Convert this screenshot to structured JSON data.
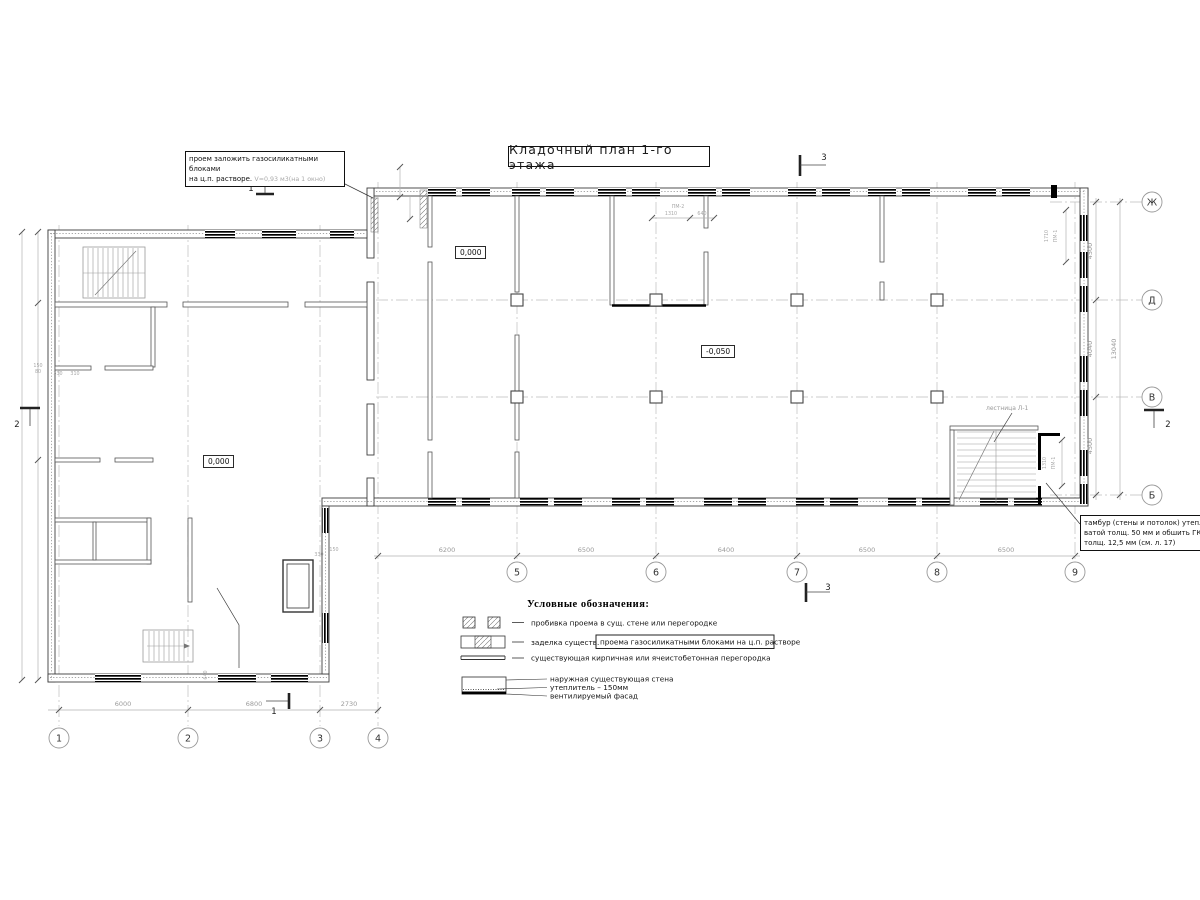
{
  "title": "Кладочный план 1-го этажа",
  "callout_opening": {
    "line1": "проем заложить газосиликатными блоками",
    "line2": "на ц.п. растворе.",
    "note": "V=0,93 м3(на 1 окно)"
  },
  "callout_tambour": {
    "line1": "тамбур (стены и потолок) утеплить",
    "line2": "ватой толщ. 50 мм и обшить ГКЛ",
    "line3": "толщ. 12,5 мм (см. л. 17)"
  },
  "elevations": {
    "hall_zero": "0,000",
    "wing_zero": "0,000",
    "hall_low": "-0,050"
  },
  "grid": {
    "cols": [
      {
        "label": "1"
      },
      {
        "label": "2"
      },
      {
        "label": "3"
      },
      {
        "label": "4"
      },
      {
        "label": "5"
      },
      {
        "label": "6"
      },
      {
        "label": "7"
      },
      {
        "label": "8"
      },
      {
        "label": "9"
      }
    ],
    "rows": [
      {
        "label": "Ж"
      },
      {
        "label": "Д"
      },
      {
        "label": "В"
      },
      {
        "label": "Б"
      }
    ]
  },
  "dims": {
    "bottom_main": [
      "6200",
      "6500",
      "6400",
      "6500",
      "6500"
    ],
    "bottom_wing": [
      "6000",
      "6800",
      "2730"
    ],
    "right_segments": [
      "4500",
      "4040",
      "4500"
    ],
    "right_total": "13040",
    "pm2": {
      "label": "ПМ-2",
      "d1": "1310",
      "d2": "640"
    },
    "pm1_top": {
      "label": "ПМ-1",
      "d": "1710"
    },
    "pm1_stair": {
      "label": "ПМ-1",
      "d": "1310"
    },
    "small_left": [
      "150",
      "80",
      "330",
      "310"
    ],
    "small_tambour": [
      "330",
      "150"
    ],
    "wing_640": "640"
  },
  "labels": {
    "stair": "лестница Л-1"
  },
  "sections": {
    "s1": "1",
    "s2": "2",
    "s3": "3"
  },
  "legend": {
    "heading": "Условные обозначения:",
    "items": [
      {
        "text": "пробивка проема в сущ. стене или перегородке"
      },
      {
        "prefix": "заделка существ.",
        "boxed": "проема газосиликатными блоками на ц.п. растворе"
      },
      {
        "text": "существующая кирпичная или ячеистобетонная перегородка"
      }
    ],
    "wall": {
      "lines": [
        "наружная существующая стена",
        "утеплитель – 150мм",
        "вентилируемый фасад"
      ]
    }
  }
}
